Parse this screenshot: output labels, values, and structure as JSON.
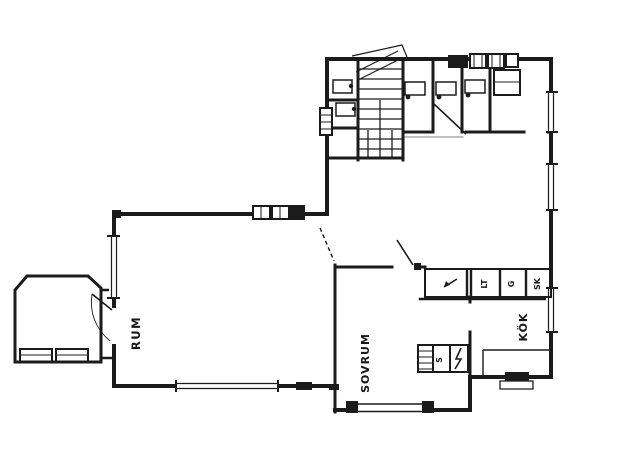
{
  "drawing": {
    "kind": "scanned floor plan",
    "paper_color": "#ffffff",
    "ink_color": "#1b1b1b"
  },
  "labels": {
    "room_left": "RUM",
    "room_bottom": "SOVRUM",
    "kitchen": "KÖK",
    "closet_1": "LT",
    "closet_2": "G",
    "closet_3": "SK",
    "sink_mark": "S"
  }
}
